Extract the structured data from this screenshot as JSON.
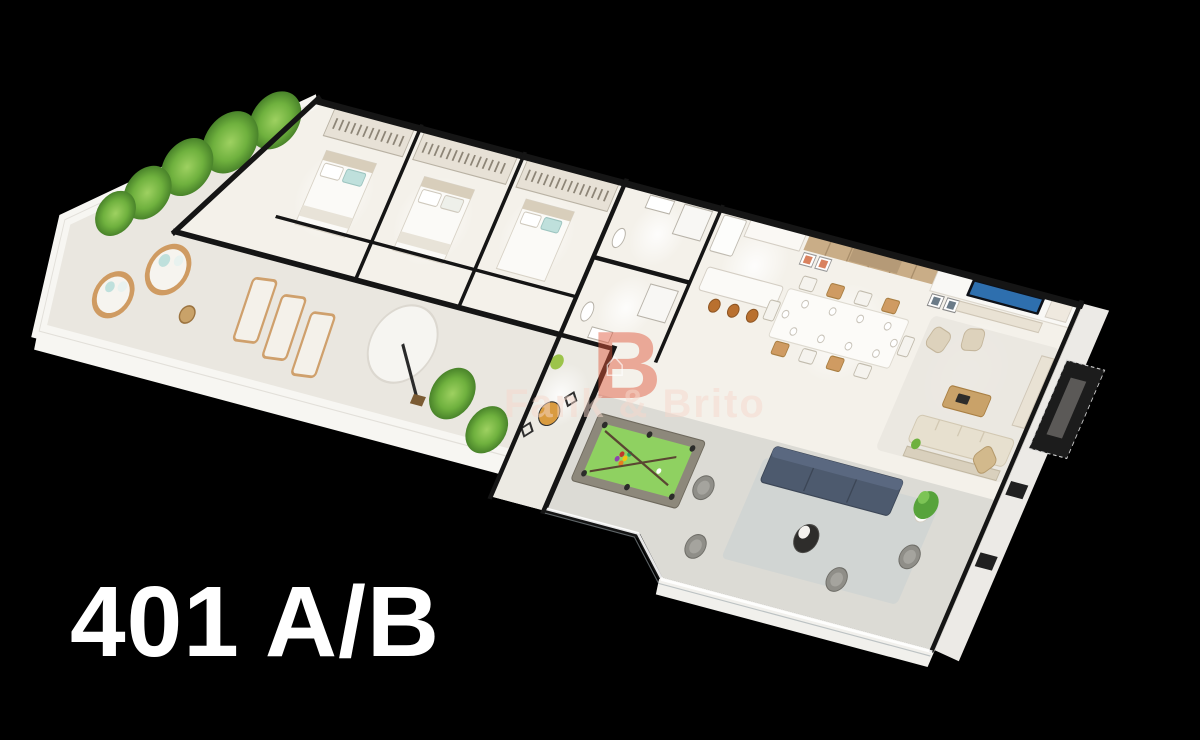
{
  "unit_label": "401 A/B",
  "watermark": {
    "text": "Fank & Brito",
    "logo_letter": "B",
    "logo_house_glyph": "⌂"
  },
  "colors": {
    "background": "#000000",
    "wall_cap": "#151515",
    "interior_floor": "#f4f1ea",
    "terrace_floor": "#eae7e0",
    "balcony_floor": "#dcdbd5",
    "bistro_floor": "#eceae3",
    "slab_edge": "#f7f6f2",
    "pool_felt": "#8fd161",
    "pool_frame": "#8d887b",
    "navy_sofa": "#4d5a6e",
    "cream_sofa": "#e7e0cf",
    "armchair_beige": "#ddd2bc",
    "wood": "#c99a62",
    "wood_wall": "#c9ad87",
    "bar_stool": "#b9702f",
    "bistro_table": "#d99b3f",
    "plant_green": "#6fb13e",
    "plant_pot_stone": "#b3aea4",
    "teal_cushion": "#bfe0dc",
    "rattan": "#cf9b62",
    "tv_screen": "#2e6fae",
    "coral_art": "#d9825f",
    "elevator_panel": "#1c1c1c",
    "glass_rail": "#ffffff",
    "watermark_accent": "#e0573c",
    "watermark_text": "#f6d8cc",
    "label_text": "#ffffff"
  }
}
